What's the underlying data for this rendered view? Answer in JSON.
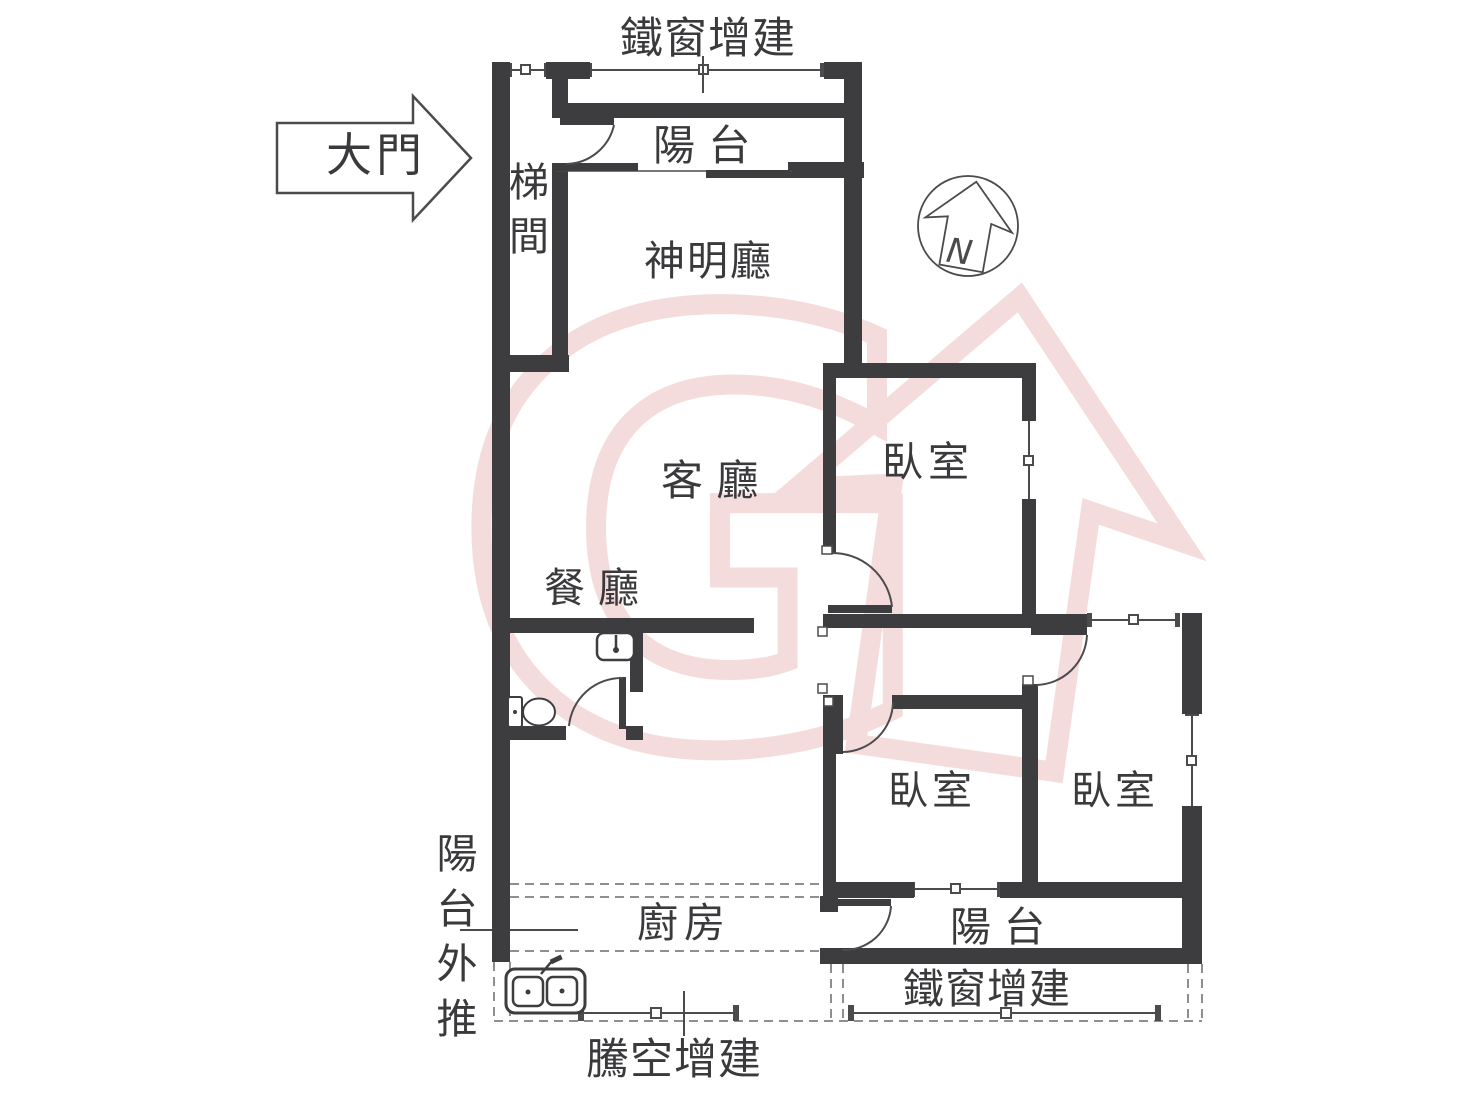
{
  "colors": {
    "wall": "#3d3d3f",
    "line": "#4b4b4d",
    "dashed_line": "#8f8f8f",
    "watermark": "#f5dcdc",
    "text": "#3a3a3c",
    "background": "#ffffff"
  },
  "rooms": {
    "stairwell": "梯間",
    "balcony_top": "陽 台",
    "shrine_hall": "神明廳",
    "living_room": "客 廳",
    "dining_room": "餐 廳",
    "bedroom_1": "臥室",
    "bedroom_2": "臥室",
    "bedroom_3": "臥室",
    "kitchen": "廚房",
    "balcony_bottom": "陽 台"
  },
  "annotations": {
    "iron_window_top": "鐵窗增建",
    "iron_window_bottom": "鐵窗增建",
    "cantilever_addition": "騰空增建",
    "balcony_pushout": "陽台外推",
    "main_entrance": "大門",
    "compass_north": "N"
  }
}
